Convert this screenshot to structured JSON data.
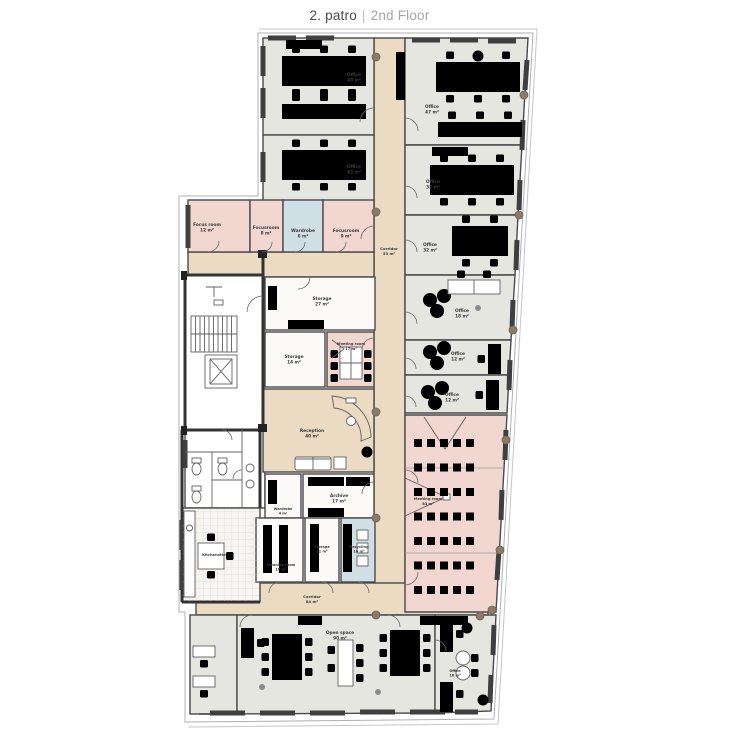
{
  "header": {
    "title_primary": "2. patro",
    "separator": "|",
    "title_secondary": "2nd Floor"
  },
  "colors": {
    "office": "#e4e6df",
    "corridor": "#eadbc2",
    "meeting": "#f2d6d0",
    "service": "#fbfaf7",
    "tech": "#cfdfe3",
    "core": "#ffffff",
    "kitchen": "#f6f5f2",
    "wall": "#4a4a4a",
    "label": "#3a3a3a",
    "column": "#8a7b6b",
    "outline": "#b0b0b0"
  },
  "rooms": [
    {
      "id": "corridor-main",
      "name": "Corridor",
      "area": "53 m²",
      "fill": "corridor",
      "rect": [
        374,
        38,
        31,
        577
      ],
      "label_at": [
        389,
        250
      ],
      "label_size": 3.8
    },
    {
      "id": "corridor-link",
      "fill": "corridor",
      "rect": [
        188,
        252,
        186,
        25
      ]
    },
    {
      "id": "corridor-patch",
      "fill": "corridor",
      "rect": [
        237,
        505,
        19,
        80
      ]
    },
    {
      "id": "corridor-lower",
      "name": "Corridor",
      "area": "84 m²",
      "fill": "corridor",
      "rect": [
        196,
        583,
        292,
        32
      ],
      "label_at": [
        312,
        598
      ],
      "label_size": 3.8
    },
    {
      "id": "office-a1",
      "name": "Office",
      "area": "48 m²",
      "fill": "office",
      "rect": [
        263,
        38,
        111,
        97
      ],
      "label_at": [
        354,
        76
      ]
    },
    {
      "id": "office-a2",
      "name": "Office",
      "area": "43 m²",
      "fill": "office",
      "rect": [
        263,
        135,
        111,
        77
      ],
      "label_at": [
        354,
        168
      ]
    },
    {
      "id": "focus-room",
      "name": "Focus room",
      "area": "12 m²",
      "fill": "meeting",
      "rect": [
        188,
        200,
        62,
        52
      ],
      "label_at": [
        207,
        226
      ]
    },
    {
      "id": "focus-room-2",
      "name": "Focusroom",
      "area": "8 m²",
      "fill": "meeting",
      "rect": [
        250,
        200,
        33,
        52
      ],
      "label_at": [
        266,
        229
      ]
    },
    {
      "id": "copy-wardrobe",
      "name": "Wardrobe",
      "area": "6 m²",
      "fill": "tech",
      "rect": [
        283,
        200,
        40,
        52
      ],
      "label_at": [
        303,
        232
      ]
    },
    {
      "id": "focus-room-3",
      "name": "Focusroom",
      "area": "9 m²",
      "fill": "meeting",
      "rect": [
        323,
        200,
        51,
        52
      ],
      "label_at": [
        346,
        232
      ]
    },
    {
      "id": "stair-core",
      "fill": "core",
      "rect": [
        185,
        275,
        78,
        155
      ]
    },
    {
      "id": "wc",
      "fill": "core",
      "rect": [
        185,
        430,
        80,
        78
      ]
    },
    {
      "id": "kitchenette",
      "name": "Kitchenette",
      "area": "",
      "fill": "kitchen",
      "rect": [
        182,
        508,
        78,
        94
      ],
      "label_at": [
        214,
        556
      ],
      "label_size": 3.6
    },
    {
      "id": "storage-27",
      "name": "Storage",
      "area": "27 m²",
      "fill": "service",
      "rect": [
        265,
        277,
        110,
        53
      ],
      "label_at": [
        322,
        300
      ]
    },
    {
      "id": "storage-14",
      "name": "Storage",
      "area": "14 m²",
      "fill": "service",
      "rect": [
        265,
        332,
        60,
        55
      ],
      "label_at": [
        294,
        358
      ]
    },
    {
      "id": "meeting-room-17",
      "name": "Meeting room",
      "area": "17 m²",
      "fill": "meeting",
      "rect": [
        327,
        332,
        47,
        55
      ],
      "label_at": [
        351,
        345
      ],
      "label_size": 3.6
    },
    {
      "id": "reception",
      "name": "Reception",
      "area": "40 m²",
      "fill": "corridor",
      "rect": [
        263,
        389,
        111,
        83
      ],
      "label_at": [
        312,
        432
      ]
    },
    {
      "id": "wardrobe-4",
      "name": "Wardrobe",
      "area": "4 m²",
      "fill": "service",
      "rect": [
        265,
        474,
        36,
        44
      ],
      "label_at": [
        283,
        510
      ],
      "label_size": 3.4
    },
    {
      "id": "archive",
      "name": "Archive",
      "area": "17 m²",
      "fill": "service",
      "rect": [
        303,
        474,
        71,
        44
      ],
      "label_at": [
        339,
        497
      ]
    },
    {
      "id": "cleaning-room",
      "name": "Cleaning room",
      "area": "16 m²",
      "fill": "service",
      "rect": [
        256,
        518,
        47,
        64
      ],
      "label_at": [
        281,
        566
      ],
      "label_size": 3.5
    },
    {
      "id": "storage-11",
      "name": "Storage",
      "area": "11 m²",
      "fill": "service",
      "rect": [
        305,
        518,
        34,
        64
      ],
      "label_at": [
        322,
        548
      ],
      "label_size": 3.5
    },
    {
      "id": "recycling",
      "name": "Recycling",
      "area": "10 m²",
      "fill": "tech",
      "rect": [
        341,
        518,
        34,
        64
      ],
      "label_at": [
        359,
        548
      ],
      "label_size": 3.5
    },
    {
      "id": "office-b1",
      "name": "Office",
      "area": "47 m²",
      "fill": "office",
      "points": "405,38 528,38 522,145 405,145",
      "label_at": [
        432,
        108
      ]
    },
    {
      "id": "office-b2",
      "name": "Office",
      "area": "32 m²",
      "fill": "office",
      "points": "405,145 522,145 518,215 405,215",
      "label_at": [
        433,
        183
      ]
    },
    {
      "id": "office-b3",
      "name": "Office",
      "area": "32 m²",
      "fill": "office",
      "points": "405,215 518,215 515,275 405,275",
      "label_at": [
        430,
        246
      ]
    },
    {
      "id": "office-b4",
      "name": "Office",
      "area": "18 m²",
      "fill": "office",
      "points": "405,275 515,275 511,340 405,340",
      "label_at": [
        462,
        312
      ]
    },
    {
      "id": "office-b5",
      "name": "Office",
      "area": "12 m²",
      "fill": "office",
      "points": "405,340 511,340 509,375 405,375",
      "label_at": [
        458,
        355
      ]
    },
    {
      "id": "office-b6",
      "name": "Office",
      "area": "12 m²",
      "fill": "office",
      "points": "405,375 509,375 507,413 405,413",
      "label_at": [
        452,
        396
      ]
    },
    {
      "id": "meeting-room-83",
      "name": "Meeting room",
      "area": "83 m²",
      "fill": "meeting",
      "points": "405,415 507,415 496,612 405,612",
      "label_at": [
        428,
        500
      ],
      "label_size": 3.6,
      "chair_grid": {
        "x0": 418,
        "y0": 443,
        "cols": 5,
        "rows": 7,
        "dx": 13,
        "dy": 24.5
      }
    },
    {
      "id": "office-small-left",
      "fill": "office",
      "rect": [
        190,
        615,
        47,
        99
      ]
    },
    {
      "id": "open-space",
      "name": "Open space",
      "area": "90 m²",
      "fill": "office",
      "points": "237,615 435,615 435,713 199,714 237,714",
      "label_at": [
        340,
        634
      ]
    },
    {
      "id": "office-b7",
      "name": "Office",
      "area": "18 m²",
      "fill": "office",
      "points": "435,615 496,615 491,711 435,713",
      "label_at": [
        455,
        672
      ],
      "label_size": 3.5
    }
  ]
}
